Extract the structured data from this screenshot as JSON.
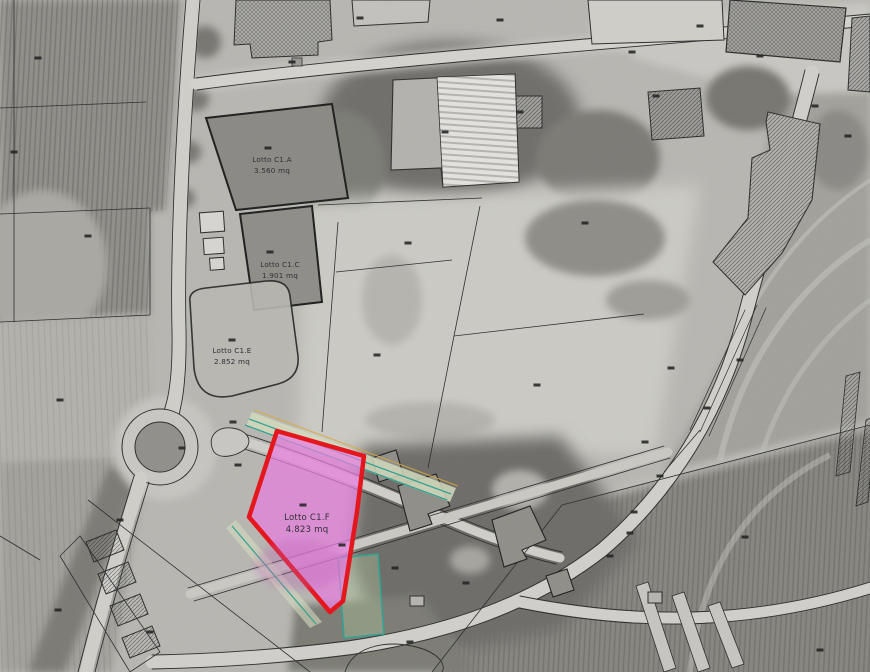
{
  "map": {
    "description": "Cadastral lot subdivision plan overlaid on grayscale aerial photograph",
    "highlighted_lot": "Lotto C1.F",
    "lots": [
      {
        "name": "Lotto C1.A",
        "area": "3.560 mq"
      },
      {
        "name": "Lotto C1.C",
        "area": "1.901 mq"
      },
      {
        "name": "Lotto C1.E",
        "area": "2.852 mq"
      },
      {
        "name": "Lotto C1.F",
        "area": "4.823 mq"
      }
    ],
    "colors": {
      "highlight_fill": "#e97de0",
      "highlight_stroke": "#e51218",
      "teal_line": "#2fa192",
      "green_strip": "#d4dabc",
      "green_fill_soft": "#aac496",
      "utility_line_yellow": "#d9a83c",
      "label_text": "#2e2c33",
      "line_dark": "#1f1f1f"
    },
    "parcel_markers": [
      [
        38,
        58
      ],
      [
        292,
        62
      ],
      [
        14,
        152
      ],
      [
        88,
        236
      ],
      [
        60,
        400
      ],
      [
        182,
        448
      ],
      [
        233,
        422
      ],
      [
        238,
        465
      ],
      [
        303,
        505
      ],
      [
        268,
        148
      ],
      [
        270,
        252
      ],
      [
        232,
        340
      ],
      [
        445,
        132
      ],
      [
        520,
        112
      ],
      [
        632,
        52
      ],
      [
        656,
        96
      ],
      [
        700,
        26
      ],
      [
        760,
        56
      ],
      [
        815,
        106
      ],
      [
        848,
        136
      ],
      [
        585,
        223
      ],
      [
        408,
        243
      ],
      [
        377,
        355
      ],
      [
        537,
        385
      ],
      [
        671,
        368
      ],
      [
        740,
        360
      ],
      [
        707,
        408
      ],
      [
        645,
        442
      ],
      [
        660,
        476
      ],
      [
        634,
        512
      ],
      [
        610,
        556
      ],
      [
        745,
        537
      ],
      [
        630,
        533
      ],
      [
        820,
        650
      ],
      [
        120,
        520
      ],
      [
        58,
        610
      ],
      [
        150,
        632
      ],
      [
        395,
        568
      ],
      [
        466,
        583
      ],
      [
        410,
        642
      ],
      [
        342,
        545
      ],
      [
        500,
        20
      ],
      [
        360,
        18
      ]
    ]
  }
}
